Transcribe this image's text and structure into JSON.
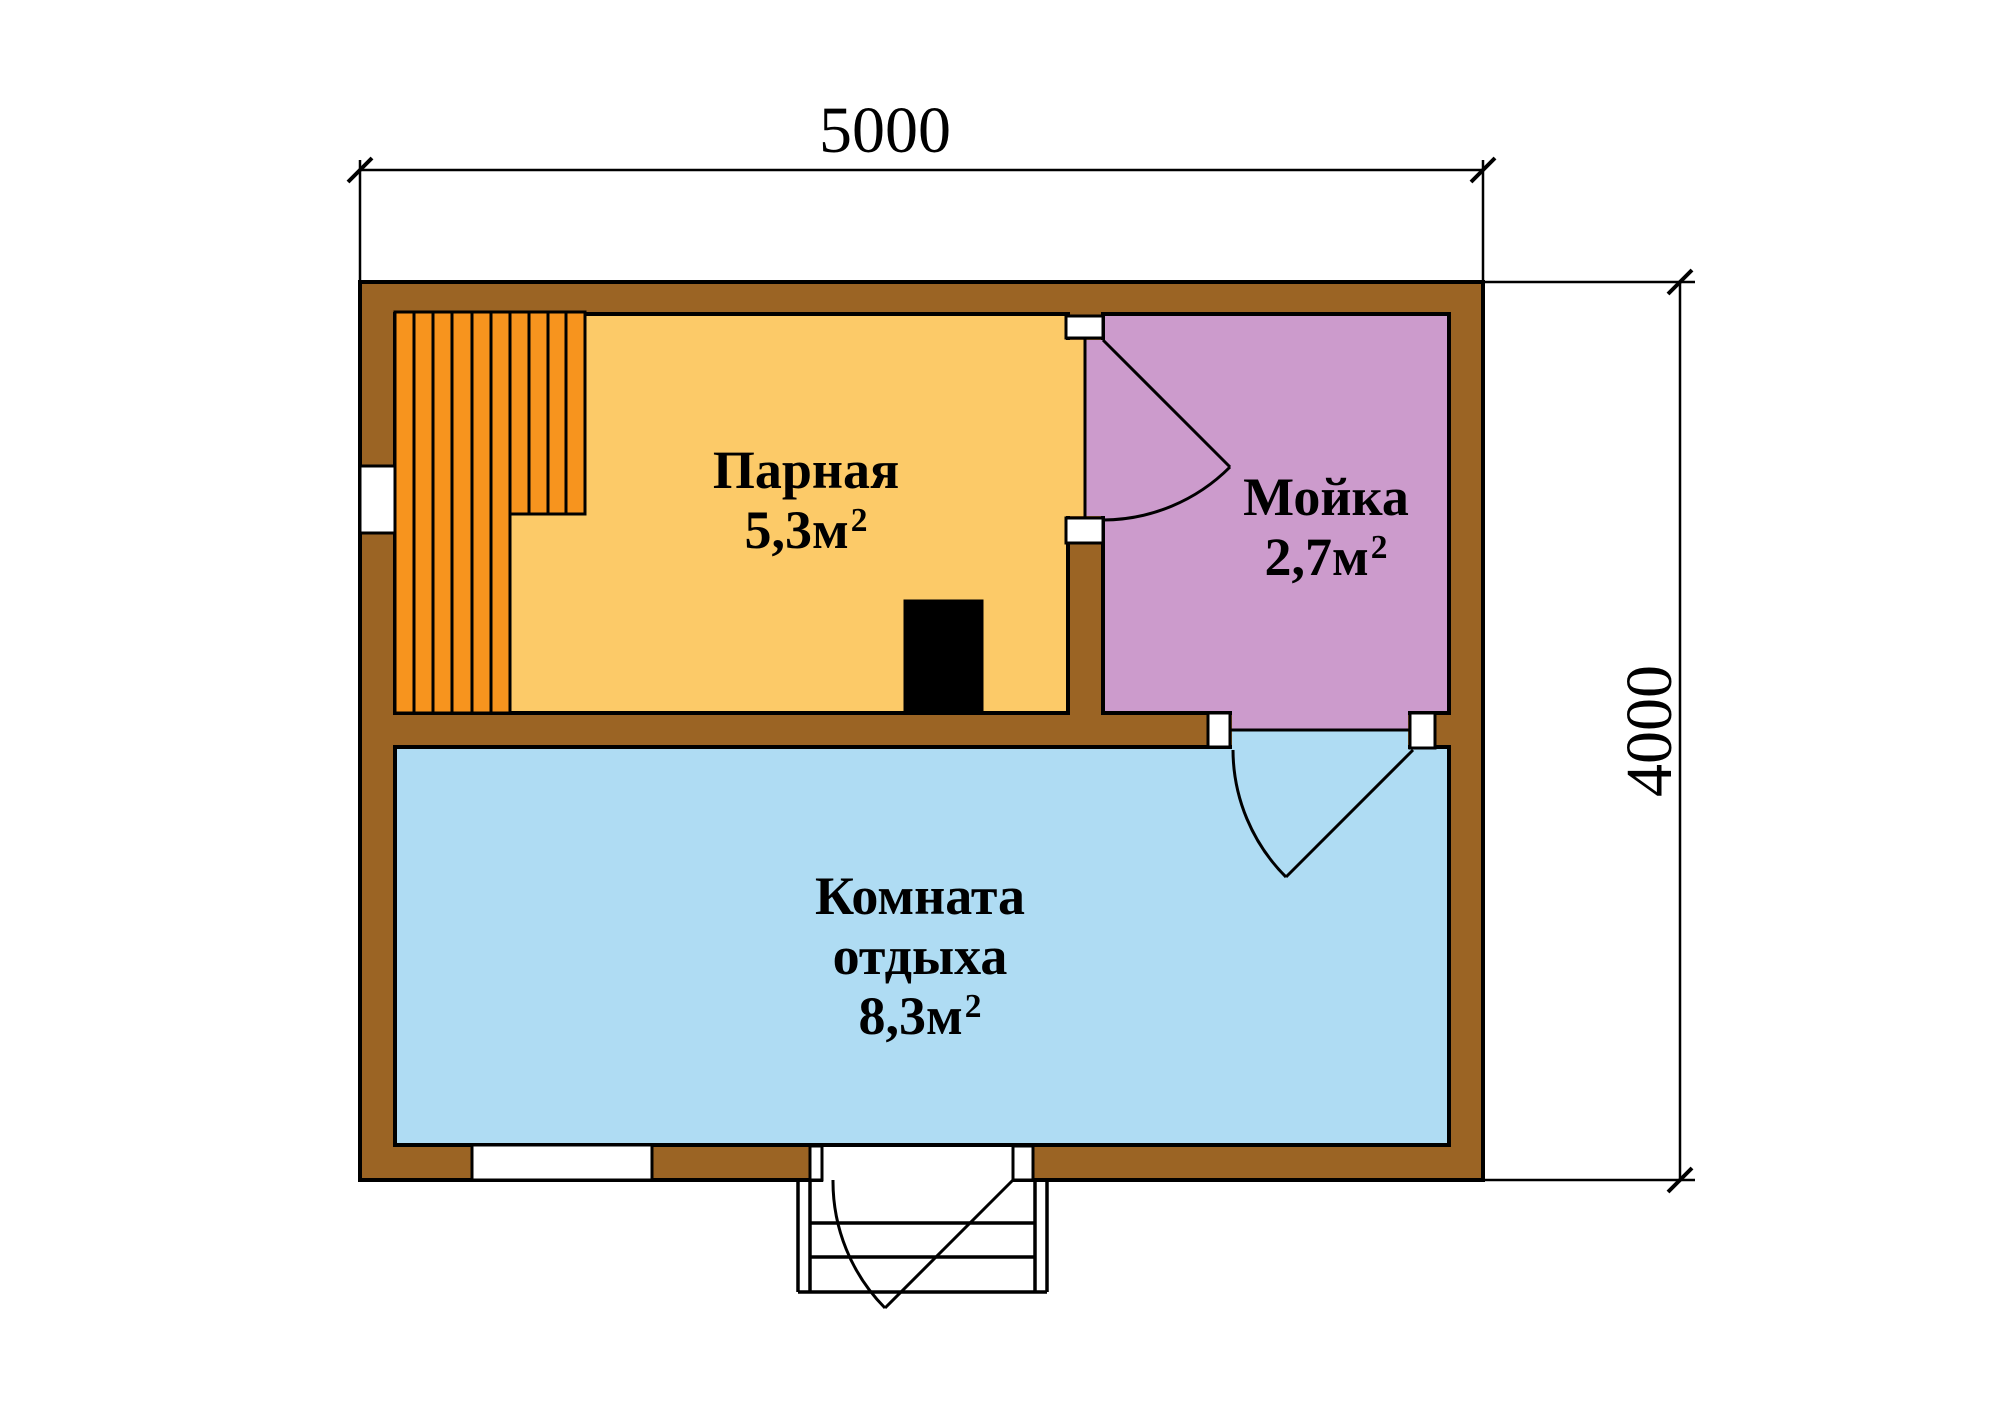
{
  "dimensions": {
    "width_mm": "5000",
    "height_mm": "4000"
  },
  "rooms": {
    "steam": {
      "name": "Парная",
      "area": "5,3м",
      "sup": "2",
      "color": "#FCCA68"
    },
    "wash": {
      "name": "Мойка",
      "area": "2,7м",
      "sup": "2",
      "color": "#CC9BCC"
    },
    "rest": {
      "name": "Комната отдыха",
      "area": "8,3м",
      "sup": "2",
      "color": "#AFDCF3"
    }
  },
  "colors": {
    "wall": "#9B6424",
    "bench": "#F7941E",
    "stove": "#000000",
    "outline": "#000000",
    "background": "#FFFFFF"
  }
}
